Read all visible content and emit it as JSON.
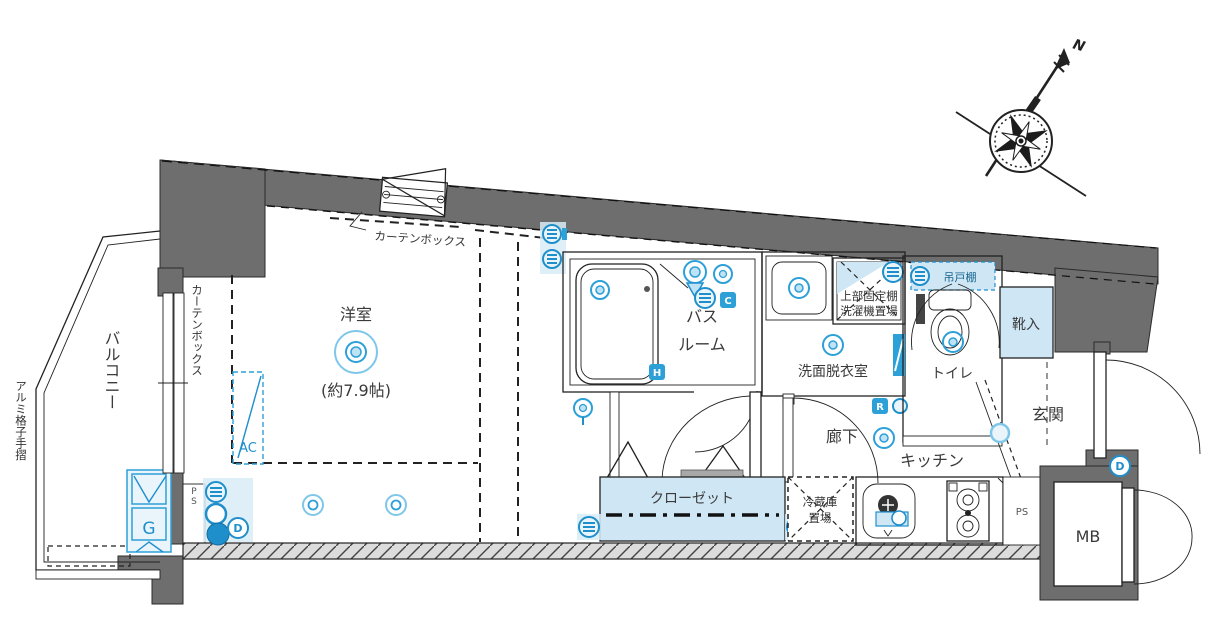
{
  "colors": {
    "wall_gray": "#6e6e6e",
    "accent_blue": "#2da0d8",
    "light_blue_fill": "#cfe7f5",
    "hatch_gray": "#dcdcdc"
  },
  "compass": {
    "north": "N"
  },
  "rooms": {
    "western_room": {
      "name": "洋室",
      "size": "(約7.9帖)"
    },
    "balcony": "バルコニー",
    "bathroom_line1": "バス",
    "bathroom_line2": "ルーム",
    "washroom": "洗面脱衣室",
    "toilet": "トイレ",
    "shoe_cabinet": "靴入",
    "entrance": "玄関",
    "hallway": "廊下",
    "kitchen": "キッチン",
    "closet": "クローゼット",
    "fridge_line1": "冷蔵庫",
    "fridge_line2": "置場",
    "meter_box": "MB"
  },
  "equipment": {
    "water_heater": "G",
    "air_conditioner": "AC",
    "pipe_space_left": "PS",
    "pipe_space_right": "PS"
  },
  "annotations": {
    "curtain_box_top": "カーテンボックス",
    "curtain_box_left": "カーテンボックス",
    "handrail": "アルミ格子手摺",
    "upper_shelf": "上部固定棚",
    "washer_place": "洗濯機置場",
    "hanging_cupboard": "吊戸棚"
  },
  "badges": {
    "c": "C",
    "h": "H",
    "r": "R",
    "d_room": "D",
    "d_entrance": "D"
  }
}
